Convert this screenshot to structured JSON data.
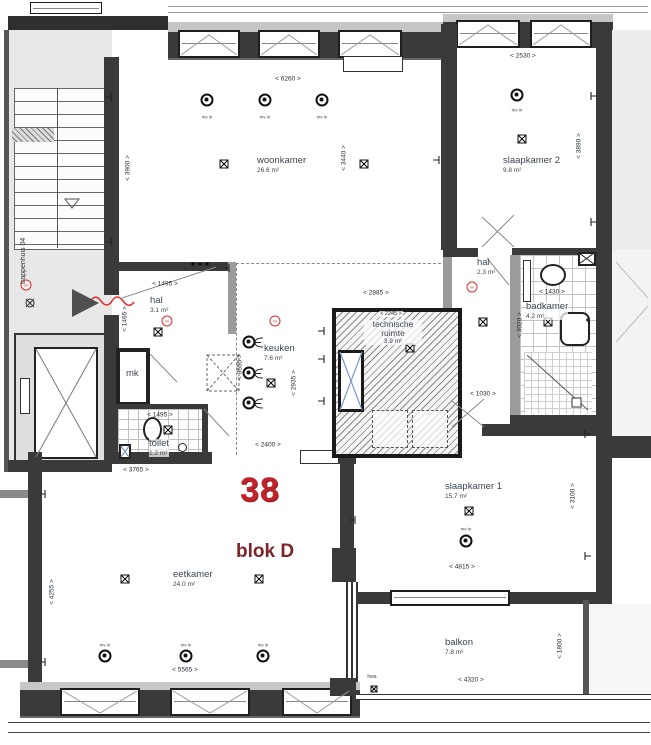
{
  "unit": {
    "number": "38",
    "block": "blok D"
  },
  "rooms": [
    {
      "name": "woonkamer",
      "area": "26.6 m²"
    },
    {
      "name": "slaapkamer 2",
      "area": "9.8 m²"
    },
    {
      "name": "hal",
      "area": "3.1 m²"
    },
    {
      "name": "keuken",
      "area": "7.6 m²"
    },
    {
      "name": "technische ruimte",
      "area": "3.9 m²"
    },
    {
      "name": "hal",
      "area": "2.3 m²"
    },
    {
      "name": "badkamer",
      "area": "4.2 m²"
    },
    {
      "name": "toilet",
      "area": "1.2 m²"
    },
    {
      "name": "mk",
      "area": ""
    },
    {
      "name": "eetkamer",
      "area": "24.0 m²"
    },
    {
      "name": "slaapkamer 1",
      "area": "15.7 m²"
    },
    {
      "name": "balkon",
      "area": "7.8 m²"
    },
    {
      "name": "trappenhuis 04",
      "area": ""
    }
  ],
  "dimensions": [
    "< 6260 >",
    "< 2530 >",
    "< 3900 >",
    "< 3440 >",
    "< 3890 >",
    "< 1495 >",
    "< 1465 >",
    "< 2885 >",
    "< 2245 >",
    "< 1430 >",
    "< 3020 >",
    "< 1030 >",
    "< 3555 >",
    "< 2935 >",
    "< 2400 >",
    "< 1495 >",
    "< 3765 >",
    "< 4255 >",
    "< 5565 >",
    "< 4815 >",
    "< 3100 >",
    "< 4320 >",
    "< 1800 >"
  ],
  "symbols": {
    "vent_label": "mv in",
    "smoke_label": "rm",
    "rainwater_label": "hwa"
  },
  "colors": {
    "unit_red": "#c2232a",
    "block_red": "#7c2428",
    "wall": "#3a3a3a"
  }
}
